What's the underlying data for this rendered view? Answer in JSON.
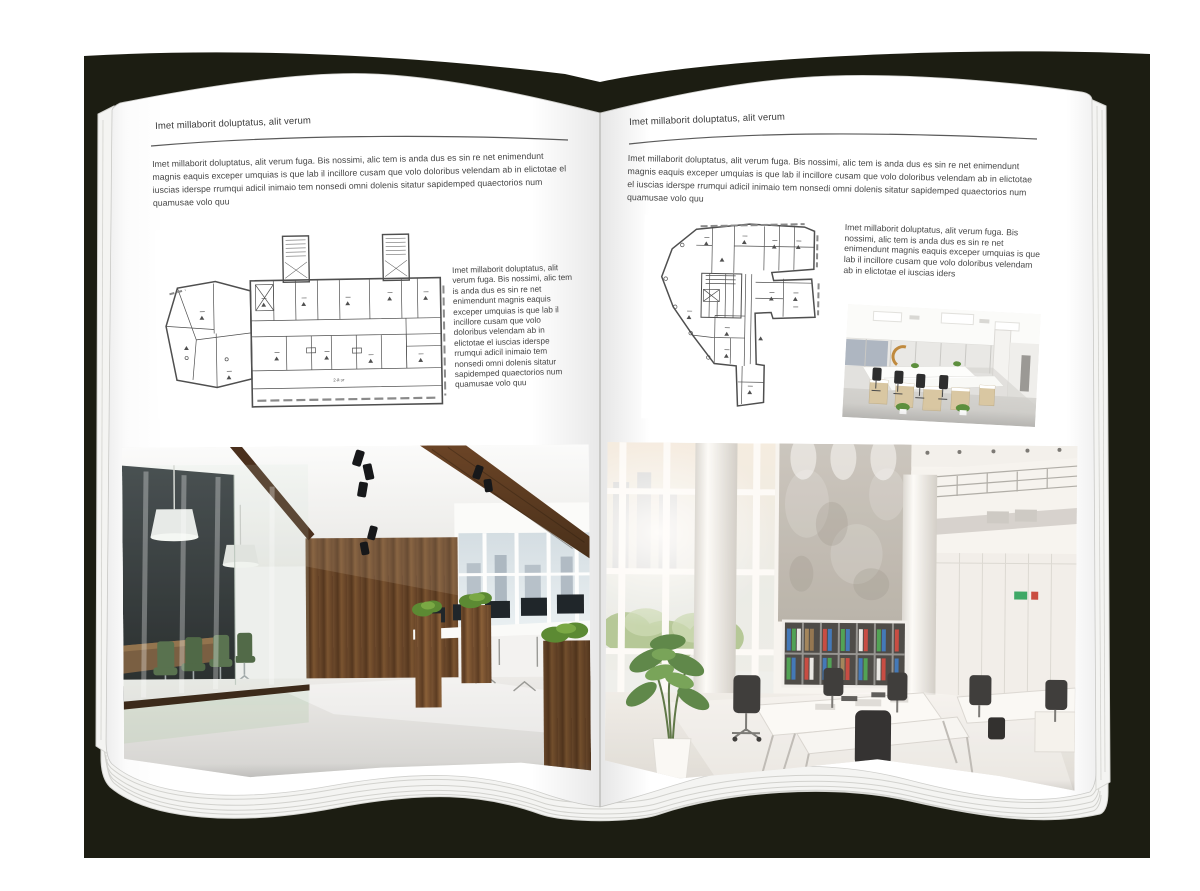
{
  "background_color": "#ffffff",
  "book": {
    "cover_color": "#1c1d12",
    "page_color": "#ffffff"
  },
  "left_page": {
    "header": "Imet millaborit doluptatus, alit verum",
    "intro": "Imet millaborit doluptatus, alit verum fuga. Bis nossimi, alic tem is anda dus es sin re net enimendunt magnis eaquis exceper umquias is que lab il incillore cusam que volo doloribus velendam ab in elictotae el iuscias iderspe rrumqui adicil inimaio tem nonsedi omni dolenis sitatur sapidemped quaectorios num quamusae volo quu",
    "floor_plan_label": "2-й эт",
    "caption": "Imet millaborit doluptatus, alit verum fuga. Bis nossimi, alic tem is anda dus es sin re net enimendunt magnis eaquis exceper umquias is que lab il incillore cusam que volo doloribus velendam ab in elictotae el iuscias iderspe rrumqui adicil inimaio tem nonsedi omni dolenis sitatur sapidemped quaectorios num quamusae volo quu"
  },
  "right_page": {
    "header": "Imet millaborit doluptatus, alit verum",
    "intro": "Imet millaborit doluptatus, alit verum fuga. Bis nossimi, alic tem is anda dus es sin re net enimendunt magnis eaquis exceper umquias is que lab il incillore cusam que volo doloribus velendam ab in elictotae el iuscias iderspe rrumqui adicil inimaio tem nonsedi omni dolenis sitatur sapidemped quaectorios num quamusae volo quu",
    "caption": "Imet millaborit doluptatus, alit verum fuga. Bis nossimi, alic tem is anda dus es sin re net enimendunt magnis eaquis exceper umquias is que lab il incillore cusam que volo doloribus velendam ab in elictotae el iuscias iders"
  }
}
